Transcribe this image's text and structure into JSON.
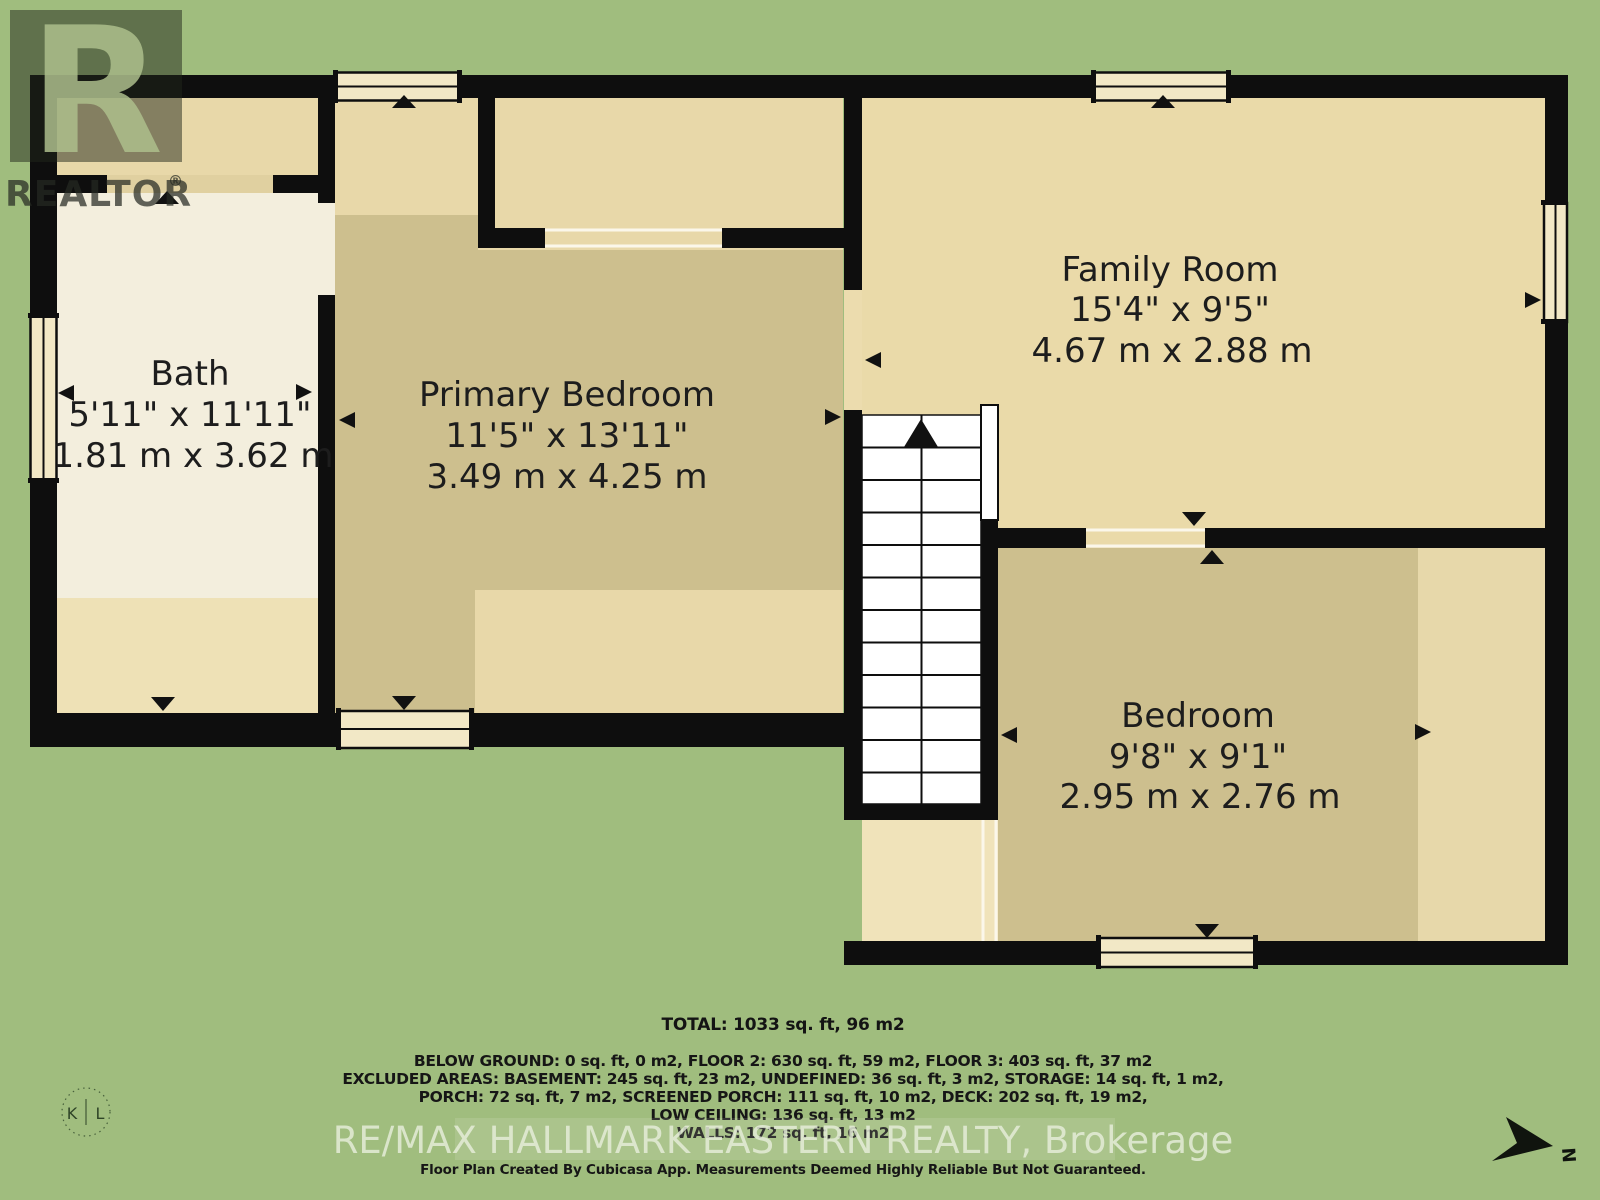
{
  "rooms": [
    {
      "name": "Bath",
      "imperial": "5'11\" x 11'11\"",
      "metric": "1.81 m x 3.62 m"
    },
    {
      "name": "Primary Bedroom",
      "imperial": "11'5\" x 13'11\"",
      "metric": "3.49 m x 4.25 m"
    },
    {
      "name": "Family Room",
      "imperial": "15'4\" x 9'5\"",
      "metric": "4.67 m x 2.88 m"
    },
    {
      "name": "Bedroom",
      "imperial": "9'8\" x 9'1\"",
      "metric": "2.95 m x 2.76 m"
    }
  ],
  "summary": {
    "total": "TOTAL: 1033 sq. ft, 96 m2",
    "lines": [
      "BELOW GROUND: 0 sq. ft, 0 m2, FLOOR 2: 630 sq. ft, 59 m2, FLOOR 3: 403 sq. ft, 37 m2",
      "EXCLUDED AREAS: BASEMENT: 245 sq. ft, 23 m2, UNDEFINED: 36 sq. ft, 3 m2, STORAGE: 14 sq. ft, 1 m2,",
      "PORCH: 72 sq. ft, 7 m2, SCREENED PORCH: 111 sq. ft, 10 m2, DECK: 202 sq. ft, 19 m2,",
      "LOW CEILING: 136 sq. ft, 13 m2",
      "WALLS: 172 sq. ft, 16 m2"
    ]
  },
  "branding": {
    "brokerage": "RE/MAX HALLMARK EASTERN REALTY, Brokerage",
    "disclaimer": "Floor Plan Created By Cubicasa App. Measurements Deemed Highly Reliable But Not Guaranteed.",
    "realtor_r": "R",
    "realtor_word": "REALTOR",
    "registered": "®",
    "photographer_left": "K",
    "photographer_right": "L"
  },
  "compass": {
    "north_label": "N"
  },
  "colors": {
    "background_green": "#a0bd7e",
    "wall_black": "#0e0e0e",
    "floor_tan": "#e8d8a9",
    "floor_dark_tan": "#cdbf8e",
    "floor_cream": "#f3eedd",
    "stairs_white": "#ffffff",
    "label_text": "#1d1d1d",
    "brokerage_text": "#e6eeda"
  }
}
